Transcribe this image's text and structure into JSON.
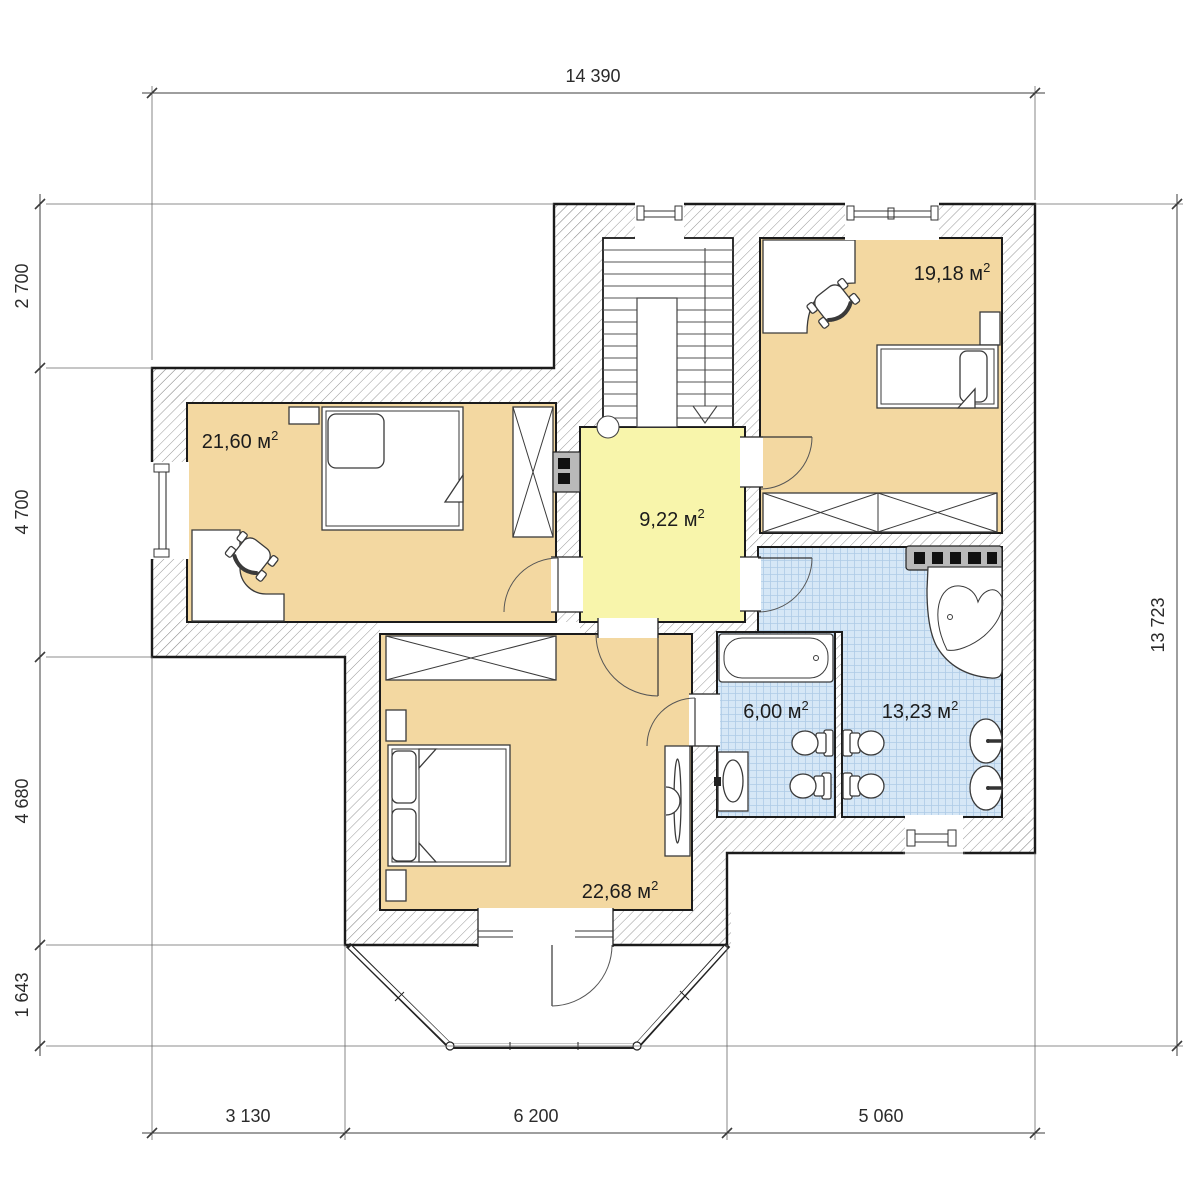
{
  "rooms": [
    {
      "id": "bedroom-1",
      "label": "21,60 м",
      "sup": "2"
    },
    {
      "id": "bedroom-2",
      "label": "19,18 м",
      "sup": "2"
    },
    {
      "id": "hall",
      "label": "9,22 м",
      "sup": "2"
    },
    {
      "id": "bathroom-small",
      "label": "6,00 м",
      "sup": "2"
    },
    {
      "id": "bathroom-large",
      "label": "13,23 м",
      "sup": "2"
    },
    {
      "id": "bedroom-master",
      "label": "22,68 м",
      "sup": "2"
    }
  ],
  "dimensions": {
    "top": "14 390",
    "right": "13 723",
    "left": [
      "2 700",
      "4 700",
      "4 680",
      "1 643"
    ],
    "bottom": [
      "3 130",
      "6 200",
      "5 060"
    ]
  },
  "colors": {
    "room-tan": "#f3d8a1",
    "room-yellow": "#f8f5ab",
    "tile-base": "#d6e7f6",
    "tile-line": "#aecbe6",
    "wall-line": "#1b1b1b",
    "hatch-line": "#989898",
    "dim-line": "#3c3c3c",
    "fixture-gray": "#b9b9b9",
    "furniture-line": "#3a3a3a"
  }
}
